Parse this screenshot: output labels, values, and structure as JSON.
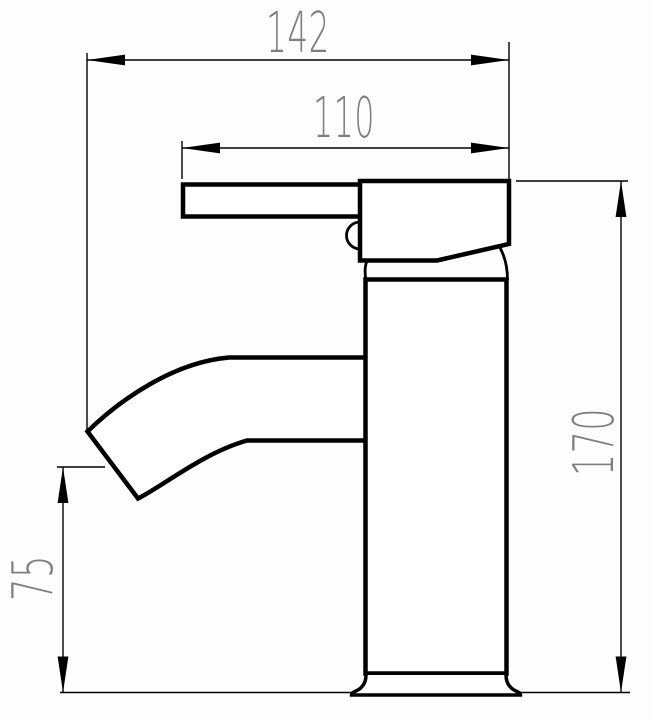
{
  "drawing": {
    "kind": "technical-dimension-drawing",
    "subject": "single-lever basin mixer tap, side view",
    "units": "mm",
    "background_color": "#fdfdfd",
    "line_color": "#000000",
    "dimension_text_color": "#7e7e7e",
    "dimensions": {
      "overall_width": {
        "label": "142",
        "value": 142,
        "orientation": "horizontal"
      },
      "upper_width": {
        "label": "110",
        "value": 110,
        "orientation": "horizontal"
      },
      "overall_height": {
        "label": "170",
        "value": 170,
        "orientation": "vertical"
      },
      "spout_height": {
        "label": "75",
        "value": 75,
        "orientation": "vertical"
      }
    }
  }
}
